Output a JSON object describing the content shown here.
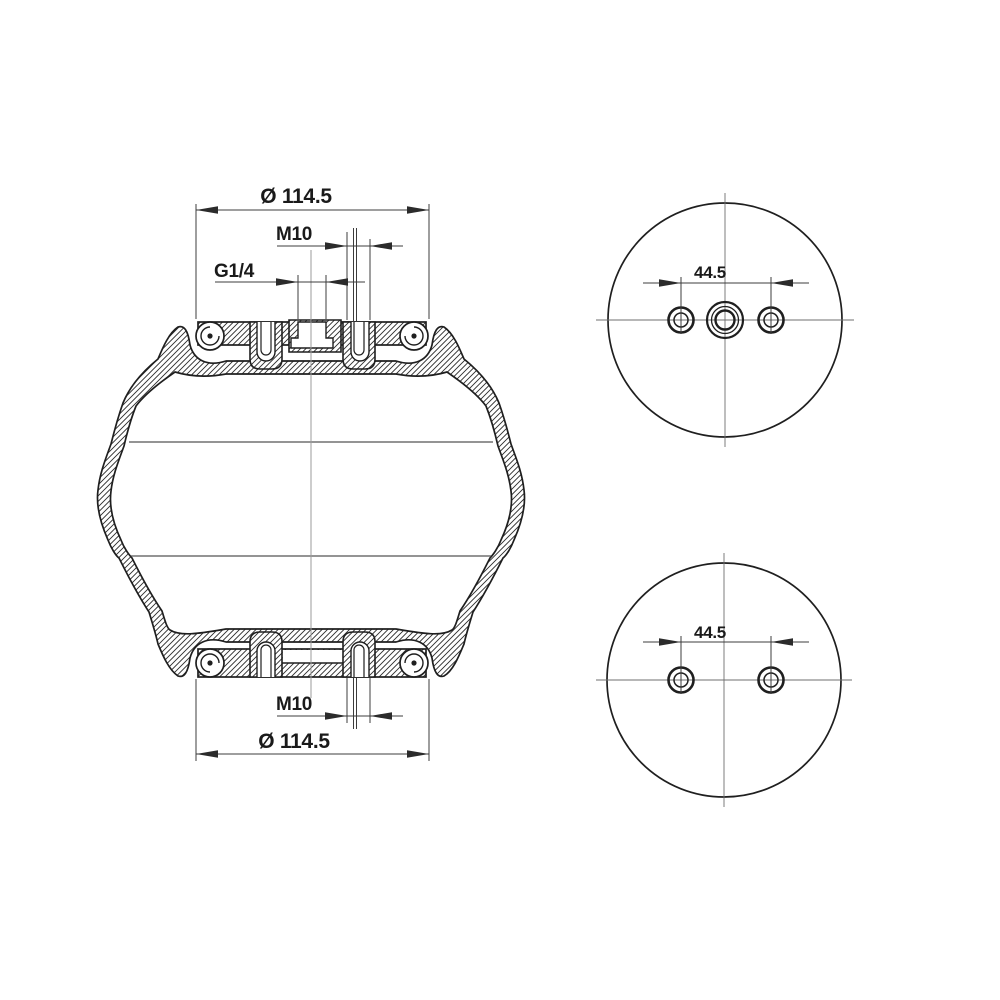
{
  "drawing": {
    "background_color": "#ffffff",
    "line_color": "#1f1f1f",
    "side_view": {
      "top_diameter": "Ø 114.5",
      "top_thread": "M10",
      "air_port": "G1/4",
      "bottom_thread": "M10",
      "bottom_diameter": "Ø 114.5"
    },
    "top_view": {
      "bolt_spacing": "44.5"
    },
    "bottom_view": {
      "bolt_spacing": "44.5"
    }
  }
}
